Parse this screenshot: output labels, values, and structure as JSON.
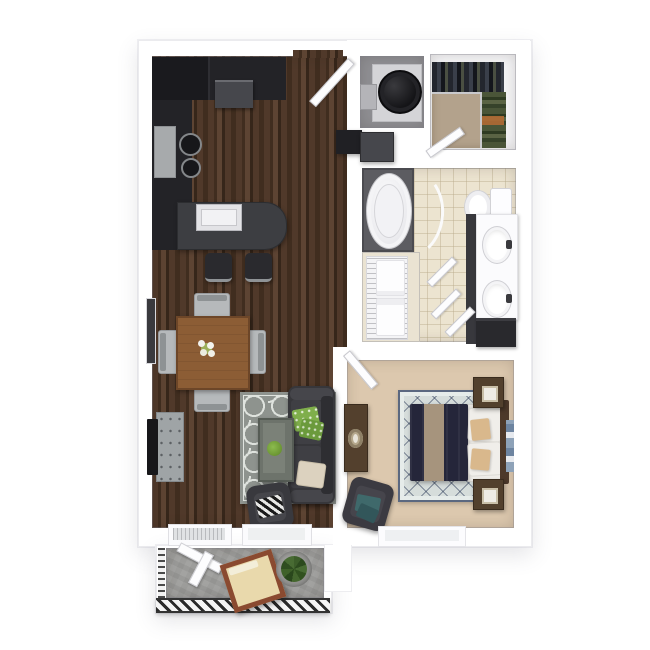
{
  "meta": {
    "scene": "3D top-down apartment floor plan rendering",
    "unit_type": "1 bedroom, 1 bathroom apartment with balcony",
    "visible_text": "none"
  },
  "rooms": [
    {
      "id": "kitchen",
      "label": "Kitchen",
      "floor": "dark hardwood",
      "furniture": [
        "refrigerator",
        "dark L-shaped counter",
        "range with two burners",
        "wall appliance",
        "island with sink",
        "two bar stools"
      ]
    },
    {
      "id": "dining",
      "label": "Dining area",
      "floor": "dark hardwood",
      "furniture": [
        "wood dining table",
        "four silver chairs",
        "flower centerpiece"
      ]
    },
    {
      "id": "living",
      "label": "Living room",
      "floor": "dark hardwood",
      "furniture": [
        "gray quatrefoil rug",
        "charcoal sofa",
        "green pillows",
        "cream pillow",
        "coffee table with plant",
        "accent armchair with patterned pillow",
        "media console",
        "wall TV",
        "side window"
      ]
    },
    {
      "id": "entry",
      "label": "Entry",
      "furniture": [
        "front door"
      ]
    },
    {
      "id": "laundry",
      "label": "Laundry closet",
      "floor": "gray",
      "furniture": [
        "washer",
        "side shelf"
      ]
    },
    {
      "id": "walk_in_closet",
      "label": "Walk-in closet",
      "floor": "tan carpet",
      "furniture": [
        "hanging clothes along two walls",
        "closet door"
      ]
    },
    {
      "id": "bathroom",
      "label": "Bathroom",
      "floor": "beige tile",
      "furniture": [
        "oval bathtub with curved shower rod",
        "toilet",
        "double-sink vanity with dark cabinet",
        "linen shelves with towels",
        "doors"
      ]
    },
    {
      "id": "bedroom",
      "label": "Bedroom",
      "floor": "tan carpet",
      "furniture": [
        "bed with navy duvet and tan runner",
        "white and tan pillows",
        "headboard",
        "two nightstands with lamps",
        "dresser with oval tray",
        "armchair with teal pillows",
        "diamond lattice rug",
        "wall decor",
        "window"
      ]
    },
    {
      "id": "balcony",
      "label": "Balcony",
      "floor": "concrete",
      "furniture": [
        "striped metal railing",
        "white folding chair",
        "wood lounge chair with cream cushion",
        "potted plant"
      ]
    }
  ],
  "colors": {
    "wood_a": "#50392a",
    "wood_b": "#402d1f",
    "wood_c": "#5d4433",
    "wood_d": "#36261a",
    "counter": "#232327",
    "fridge": "#1a1a1e",
    "appliance": "#46474c",
    "island": "#3d3e42",
    "steel": "#a7aaac",
    "stool": "#2a2a2e",
    "table": "#8c5d35",
    "table_edge": "#6d4628",
    "chair_silver": "#b6b9bb",
    "chair_back": "#8e9294",
    "window_dark": "#3a3a3e",
    "console": "#9fa4a6",
    "tv": "#17171a",
    "rug_base": "#8e938e",
    "rug_pat": "#dfe3de",
    "sofa": "#37373b",
    "sofa_light": "#46464b",
    "sofa_dark": "#2e2e32",
    "seat": "#3f3f44",
    "pillow_green": "#7fae4b",
    "pillow_green2": "#6b9a3c",
    "pillow_cream": "#dcd2bf",
    "ctable": "#6d736b",
    "ctable_top": "#7b8178",
    "plant": "#6f9c39",
    "achair": "#39393e",
    "laundry_floor": "#8f8f93",
    "pedestal": "#d4d4d7",
    "washer": "#141417",
    "closet_floor": "#f4f4f6",
    "closet_carpet": "#b3a28c",
    "tile": "#ece4d0",
    "alcove": "#5c5c61",
    "fixture": "#fbfbfd",
    "fixture_line": "#cfcfd4",
    "vanity_dark": "#38383d",
    "cabinet": "#29292d",
    "carpet": "#dcc8ae",
    "rug_bed": "#d6dddb",
    "navy": "#25263a",
    "runner": "#a6947d",
    "headboard": "#4d392a",
    "nstand": "#52402d",
    "nstand_edge": "#3a2c1e",
    "pil_white": "#f0eeea",
    "pil_tan": "#d9b88c",
    "dresser": "#53402d",
    "tray_rim": "#b5a88c",
    "bchair": "#3b3a41",
    "teal": "#3f696b",
    "teal2": "#32565a",
    "decor_blue": "#8ea2b8",
    "concrete": "#9d9d9b",
    "rail": "#2a2a2a",
    "rail_bg": "#f4f4f4",
    "chairwood": "#8a4a30",
    "cushion": "#e9d9ac",
    "pot": "#9a9a98",
    "leaves": "#3c5d2a",
    "leaves2": "#2c4a1e"
  }
}
